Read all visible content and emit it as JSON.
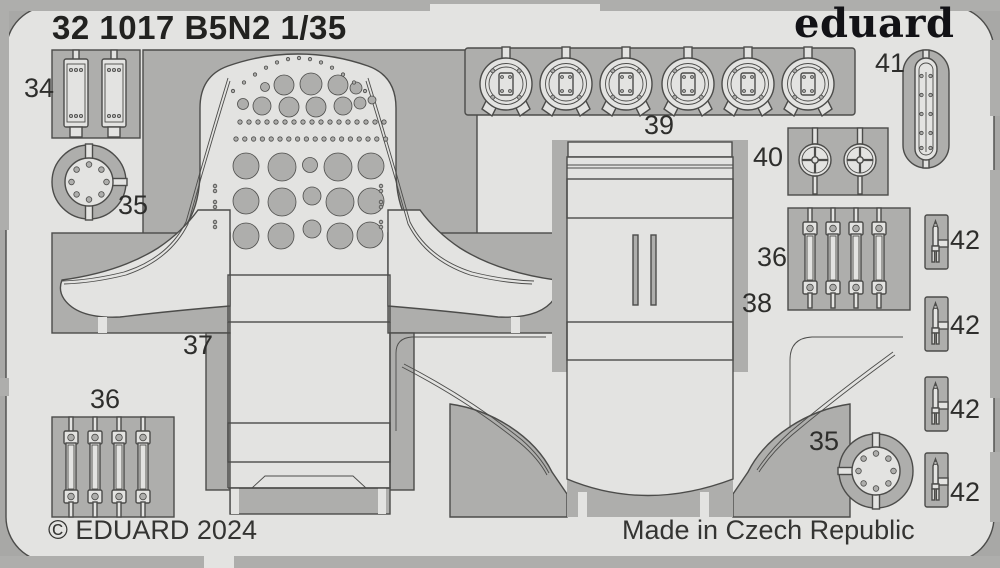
{
  "sheet": {
    "title": "32 1017 B5N2 1/35",
    "brand": "eduard",
    "copyright": "© EDUARD 2024",
    "made_in": "Made in Czech Republic"
  },
  "part_labels": {
    "p34": "34",
    "p35_top": "35",
    "p35_bottom": "35",
    "p36_left": "36",
    "p36_right": "36",
    "p37": "37",
    "p38": "38",
    "p39": "39",
    "p40": "40",
    "p41": "41",
    "p42_1": "42",
    "p42_2": "42",
    "p42_3": "42",
    "p42_4": "42"
  },
  "colors": {
    "background": "#a8a8a6",
    "cutout": "#aeaeac",
    "sheet": "#e3e3e1",
    "outline": "#4c4c4a",
    "text": "#2e2e2c",
    "logo": "#121216"
  }
}
